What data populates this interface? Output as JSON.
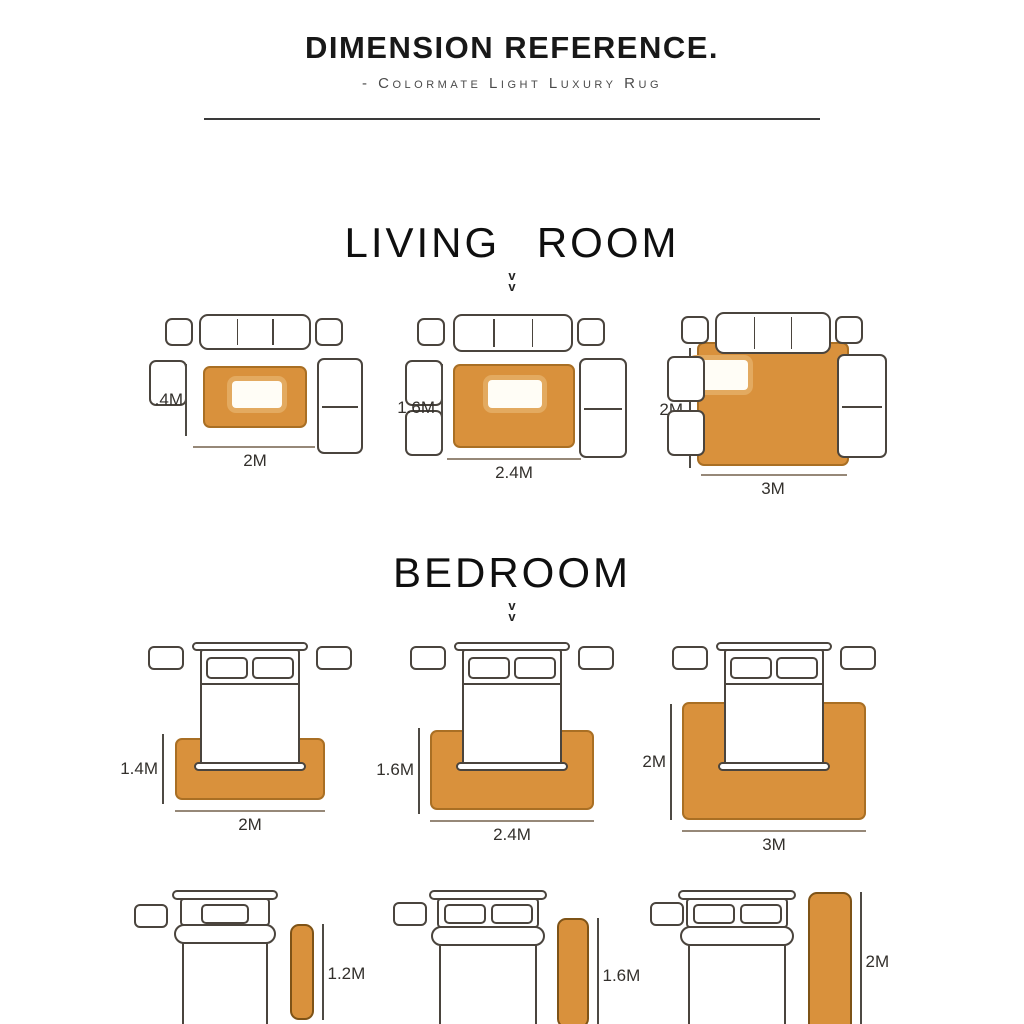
{
  "header": {
    "title": "DIMENSION REFERENCE.",
    "subtitle": "- Colormate Light Luxury Rug"
  },
  "sections": {
    "living": {
      "heading": "LIVING ROOM",
      "chevron": "v",
      "diagrams": [
        {
          "height_label": ".4M",
          "width_label": "2M"
        },
        {
          "height_label": "1.6M",
          "width_label": "2.4M"
        },
        {
          "height_label": "2M",
          "width_label": "3M"
        }
      ]
    },
    "bedroom": {
      "heading": "BEDROOM",
      "chevron": "v",
      "diagrams": [
        {
          "height_label": "1.4M",
          "width_label": "2M"
        },
        {
          "height_label": "1.6M",
          "width_label": "2.4M"
        },
        {
          "height_label": "2M",
          "width_label": "3M"
        }
      ],
      "runners": [
        {
          "height_label": "1.2M",
          "width_label": "0.4M"
        },
        {
          "height_label": "1.6M",
          "width_label": "0.6M"
        },
        {
          "height_label": "2M",
          "width_label": "0.8M"
        }
      ]
    }
  },
  "colors": {
    "rug_fill": "#d9913c",
    "rug_border": "#a96f24",
    "furniture_outline": "#4a443d",
    "heading_text": "#0f0f0f"
  }
}
